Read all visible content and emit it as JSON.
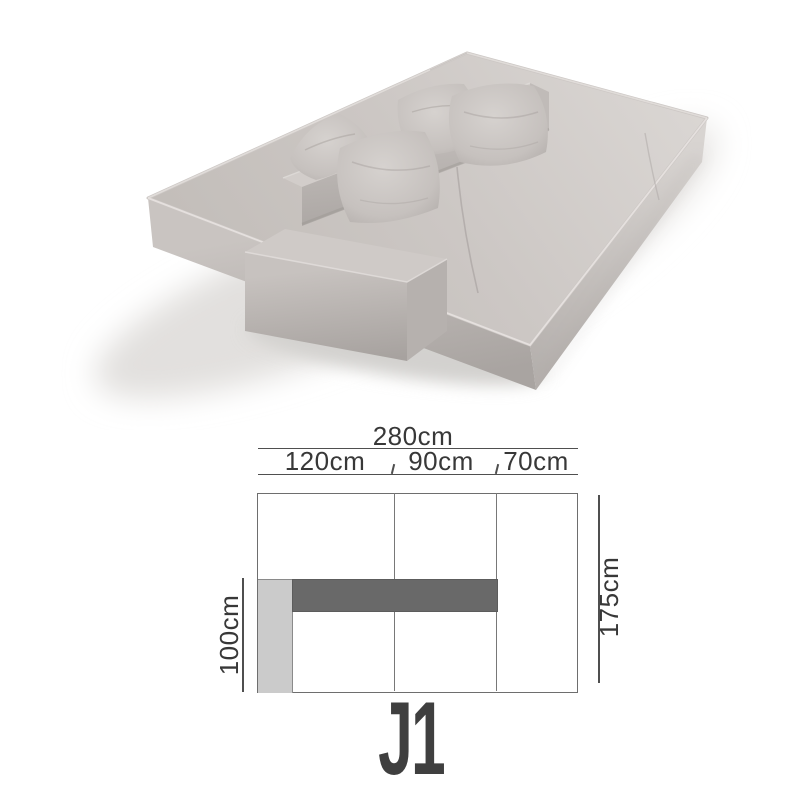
{
  "product": {
    "type": "modular fabric sofa render, light grey, low backrest, four cushions, left chaise armrest",
    "model_label": "J1",
    "fabric_color": "#c8c3c0"
  },
  "diagram": {
    "total_dimension": {
      "label": "280cm",
      "value_cm": 280
    },
    "segments": [
      {
        "label": "120cm",
        "value_cm": 120
      },
      {
        "label": "90cm",
        "value_cm": 90
      },
      {
        "label": "70cm",
        "value_cm": 70
      }
    ],
    "depth_dimension": {
      "label": "175cm",
      "value_cm": 175
    },
    "chaise_dimension": {
      "label": "100cm",
      "value_cm": 100
    },
    "colors": {
      "outline": "#6e6e6e",
      "dimension_lines": "#4f4f4f",
      "backrest_fill": "#696969",
      "armrest_fill": "#cbcbcb",
      "text": "#383838",
      "model_text": "#3f3f3f"
    }
  }
}
